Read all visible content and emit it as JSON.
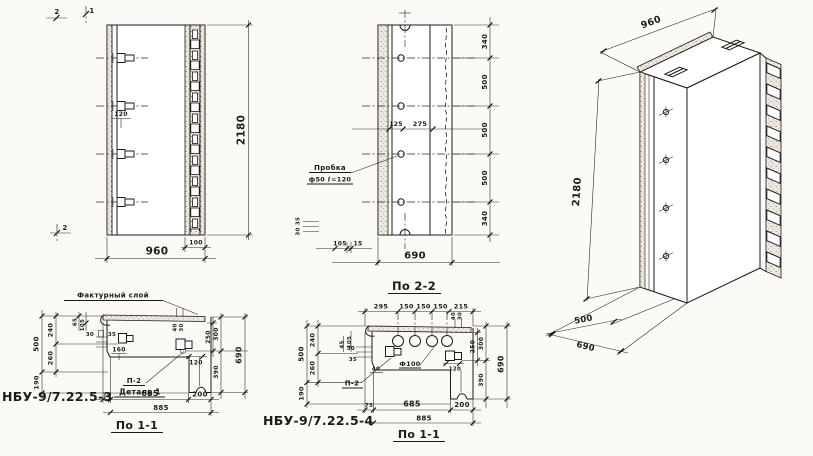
{
  "meta": {
    "paper": "#fbfaf6",
    "ink": "#1b1b1b"
  },
  "elevation": {
    "mark_2_top": "2",
    "mark_1_top": "1",
    "mark_2_bottom": "2",
    "dim_120": "120",
    "dim_960": "960",
    "dim_100": "100",
    "dim_2180": "2180"
  },
  "section22": {
    "title": "По 2-2",
    "plug_line1": "Пробка",
    "plug_line2": "ф50 ℓ=120",
    "dim_125": "125",
    "dim_275": "275",
    "dims_right": [
      "340",
      "500",
      "500",
      "500",
      "340"
    ],
    "dim_35": "35",
    "dim_30": "30",
    "dim_105": "105",
    "dim_15": "15",
    "dim_690": "690"
  },
  "iso": {
    "dim_2180": "2180",
    "dim_960": "960",
    "dim_500": "500",
    "dim_690": "690"
  },
  "plan3": {
    "code": "НБУ-9/7.22.5-3",
    "title": "По 1-1",
    "facing_label": "Фактурный слой",
    "label_p2": "П-2",
    "label_detail": "Деталь 1",
    "dim_500": "500",
    "dim_240": "240",
    "dim_260": "260",
    "dim_190": "190",
    "dim_65": "65",
    "dim_105": "105",
    "dim_30": "30",
    "dim_35": "35",
    "dim_160": "160",
    "dim_40": "40",
    "dim_30b": "30",
    "dim_250": "250",
    "dim_300": "300",
    "dim_390": "390",
    "dim_690": "690",
    "dim_120": "120",
    "dim_75": "75",
    "dim_685": "685",
    "dim_200": "200",
    "dim_885": "885"
  },
  "plan4": {
    "code": "НБУ-9/7.22.5-4",
    "title": "По 1-1",
    "label_p2": "П-2",
    "label_f100": "Ф100",
    "dims_top": [
      "295",
      "150",
      "150",
      "150",
      "215"
    ],
    "dim_500": "500",
    "dim_240": "240",
    "dim_260": "260",
    "dim_190": "190",
    "dim_105": "105",
    "dim_45": "45",
    "dim_30": "30",
    "dim_35": "35",
    "dim_40": "40",
    "dim_40b": "40",
    "dim_30b": "30",
    "dim_250": "250",
    "dim_300": "300",
    "dim_390": "390",
    "dim_690": "690",
    "dim_120": "120",
    "dim_75": "75",
    "dim_685": "685",
    "dim_200": "200",
    "dim_885": "885"
  }
}
